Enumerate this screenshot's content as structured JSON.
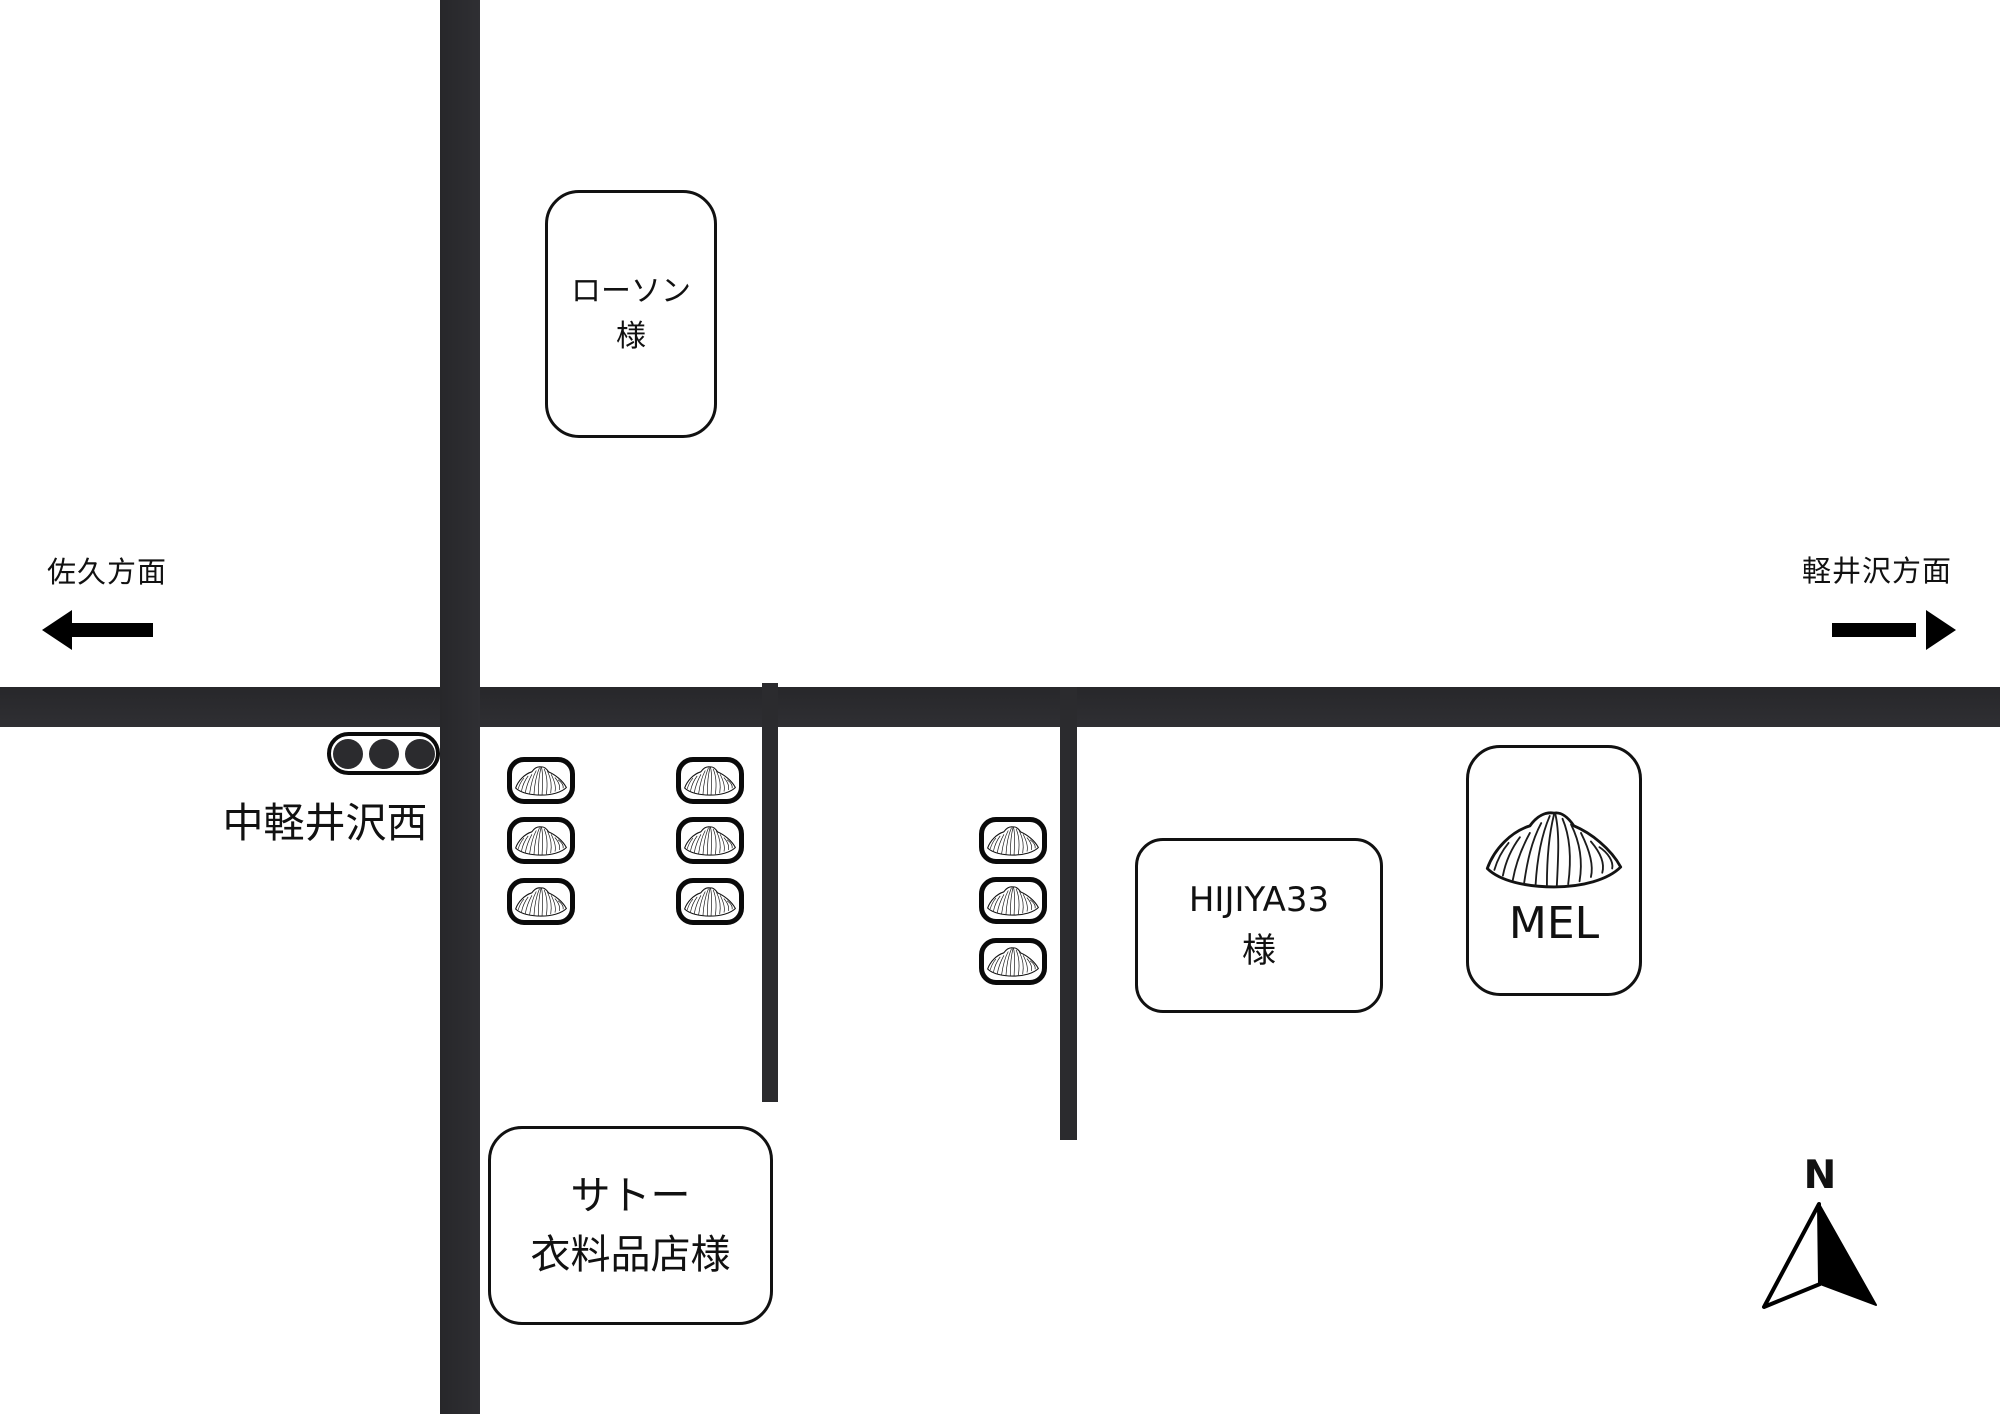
{
  "canvas": {
    "width": 2000,
    "height": 1414,
    "background": "#ffffff"
  },
  "colors": {
    "road": "#2b2b2e",
    "outline": "#111111",
    "lamp": "#2b2b2e"
  },
  "directions": {
    "west": {
      "label": "佐久方面"
    },
    "east": {
      "label": "軽井沢方面"
    }
  },
  "intersection": {
    "name": "中軽井沢西",
    "traffic_light_lamps": 3
  },
  "places": {
    "lawson": {
      "line1": "ローソン",
      "line2": "様"
    },
    "hijiya": {
      "line1": "HIJIYA33",
      "line2": "様"
    },
    "mel": {
      "label": "MEL"
    },
    "sato": {
      "line1": "サトー",
      "line2": "衣料品店様"
    }
  },
  "markers": {
    "croissant_grid_count": 6,
    "croissant_column_count": 3,
    "croissant_icon": "croissant-icon"
  },
  "compass": {
    "label": "N"
  }
}
